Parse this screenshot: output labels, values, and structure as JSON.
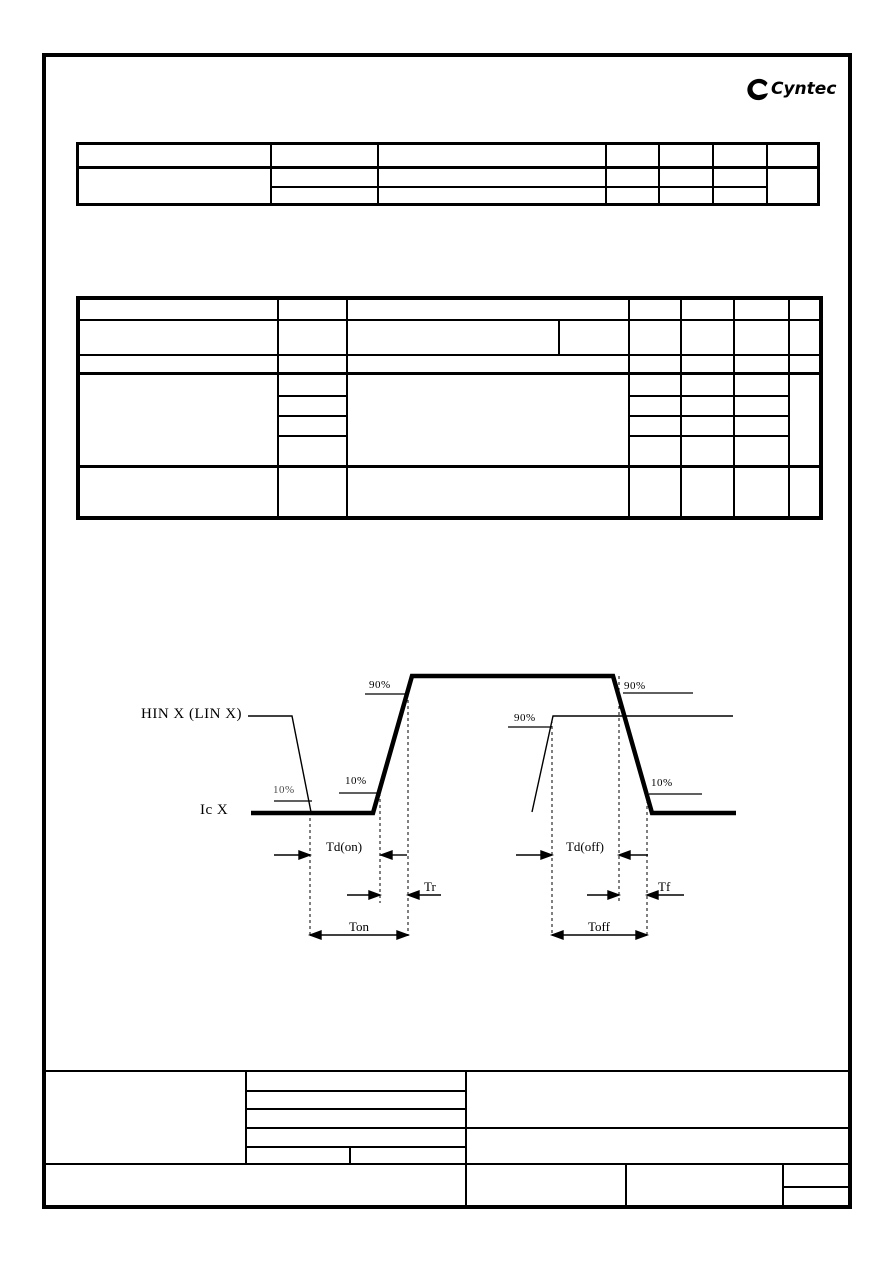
{
  "colors": {
    "ink": "#000000",
    "paper": "#ffffff"
  },
  "logo": {
    "brand": "Cyntec"
  },
  "diagram": {
    "input_label": "HIN X (LIN X)",
    "output_label": "Ic X",
    "levels": {
      "in_fall_10": "10%",
      "out_rise_10": "10%",
      "out_rise_90": "90%",
      "in_rise_90": "90%",
      "out_fall_90": "90%",
      "out_fall_10": "10%"
    },
    "timings": {
      "td_on": "Td(on)",
      "tr": "Tr",
      "ton": "Ton",
      "td_off": "Td(off)",
      "tf": "Tf",
      "toff": "Toff"
    }
  }
}
